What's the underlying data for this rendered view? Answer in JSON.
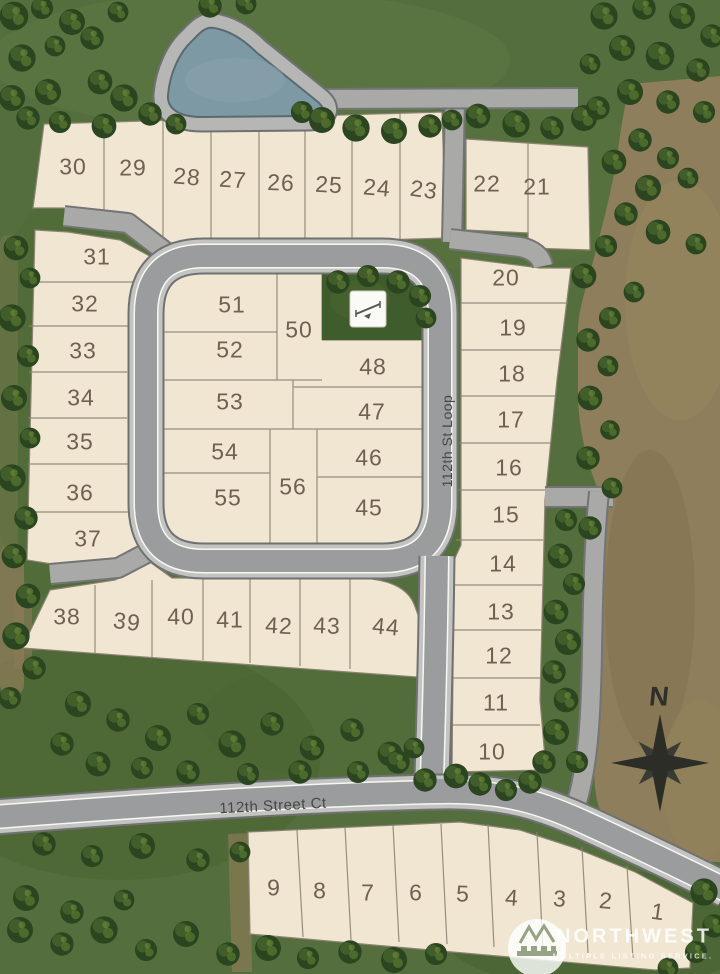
{
  "site_plan": {
    "streets": [
      {
        "name": "112th St Loop"
      },
      {
        "name": "112th Street Ct"
      }
    ],
    "lots": [
      "1",
      "2",
      "3",
      "4",
      "5",
      "6",
      "7",
      "8",
      "9",
      "10",
      "11",
      "12",
      "13",
      "14",
      "15",
      "16",
      "17",
      "18",
      "19",
      "20",
      "21",
      "22",
      "23",
      "24",
      "25",
      "26",
      "27",
      "28",
      "29",
      "30",
      "31",
      "32",
      "33",
      "34",
      "35",
      "36",
      "37",
      "38",
      "39",
      "40",
      "41",
      "42",
      "43",
      "44",
      "45",
      "46",
      "47",
      "48",
      "50",
      "51",
      "52",
      "53",
      "54",
      "55",
      "56"
    ],
    "compass": {
      "north_label": "N"
    },
    "watermark": {
      "brand": "NORTHWEST",
      "tagline": "MULTIPLE LISTING SERVICE."
    },
    "amenities": [
      {
        "name": "pond"
      },
      {
        "name": "playground"
      },
      {
        "name": "open-space-park"
      }
    ],
    "colors": {
      "grass": "#546f3d",
      "dirt": "#8e7e5b",
      "lot_fill": "#f1e6d2",
      "road_asphalt": "#9b9c9e",
      "road_curb": "#c3c3c1",
      "pond": "#7d99a3",
      "tree": "#2a451f",
      "lot_number_text": "#6f6050"
    }
  }
}
